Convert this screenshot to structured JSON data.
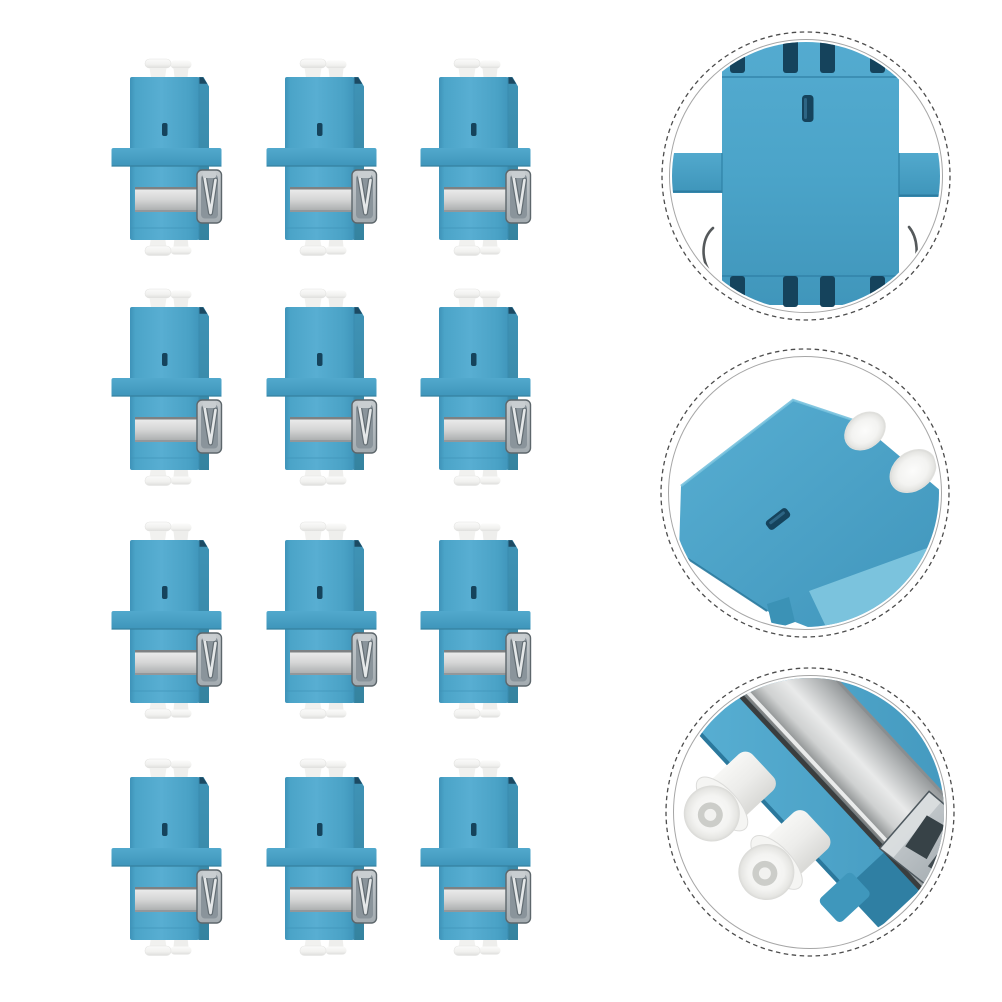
{
  "image": {
    "kind": "product-photo",
    "subject": "blue-lc-duplex-fiber-optic-adapters",
    "background": "#FFFFFF"
  },
  "grid": {
    "rows": 4,
    "columns": 3,
    "item_count": 12,
    "item": "blue-lc-duplex-adapter"
  },
  "detail_views": [
    {
      "id": "top",
      "shape": "dashed-circle",
      "content": "adapter-top-face-closeup"
    },
    {
      "id": "middle",
      "shape": "dashed-circle",
      "content": "adapter-angled-body-closeup"
    },
    {
      "id": "bottom",
      "shape": "dashed-circle",
      "content": "adapter-ferrule-end-closeup"
    }
  ],
  "colors": {
    "background": "#FFFFFF",
    "body_blue": "#4BA4C9",
    "body_blue_light": "#58AED2",
    "body_blue_dark": "#3E94BA",
    "side_blue": "#3A8CAB",
    "edge_blue": "#2E7EA3",
    "slot_navy": "#15435C",
    "metal_light": "#EDEDEE",
    "metal_mid": "#D3D4D4",
    "metal_dark": "#8F9394",
    "latch_gray": "#AEB4B7",
    "latch_recess": "#8A949B",
    "cap_white": "#F6F6F4",
    "cap_shade": "#DEDEDC",
    "ring_dark": "#4C4C4C",
    "ring_light": "#A6A6A6"
  }
}
